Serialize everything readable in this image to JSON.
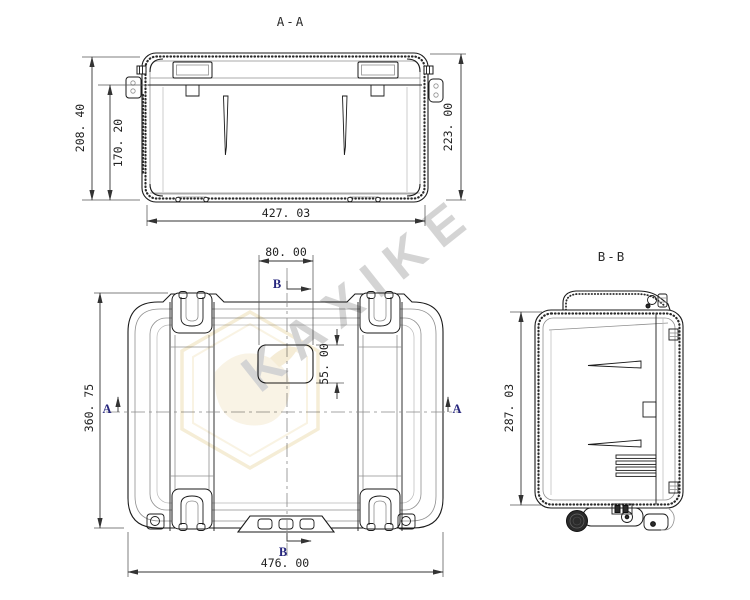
{
  "watermark": {
    "text": "KAXIKE"
  },
  "section_aa": {
    "label": "A-A",
    "dim_outer_height": "208. 40",
    "dim_inner_height": "170. 20",
    "dim_total_height": "223. 00",
    "dim_width": "427. 03"
  },
  "top_view": {
    "dim_height": "360. 75",
    "dim_width": "476. 00",
    "dim_recess_width": "80. 00",
    "dim_recess_height": "55. 00",
    "marker_a": "A",
    "marker_b": "B"
  },
  "section_bb": {
    "label": "B-B",
    "dim_height": "287. 03"
  },
  "colors": {
    "line": "#1a1a1a",
    "dimension_text": "#222222",
    "section_marker": "#26267d",
    "watermark_gray": "#cdcdcd",
    "logo_tan": "#f3e8cd"
  }
}
